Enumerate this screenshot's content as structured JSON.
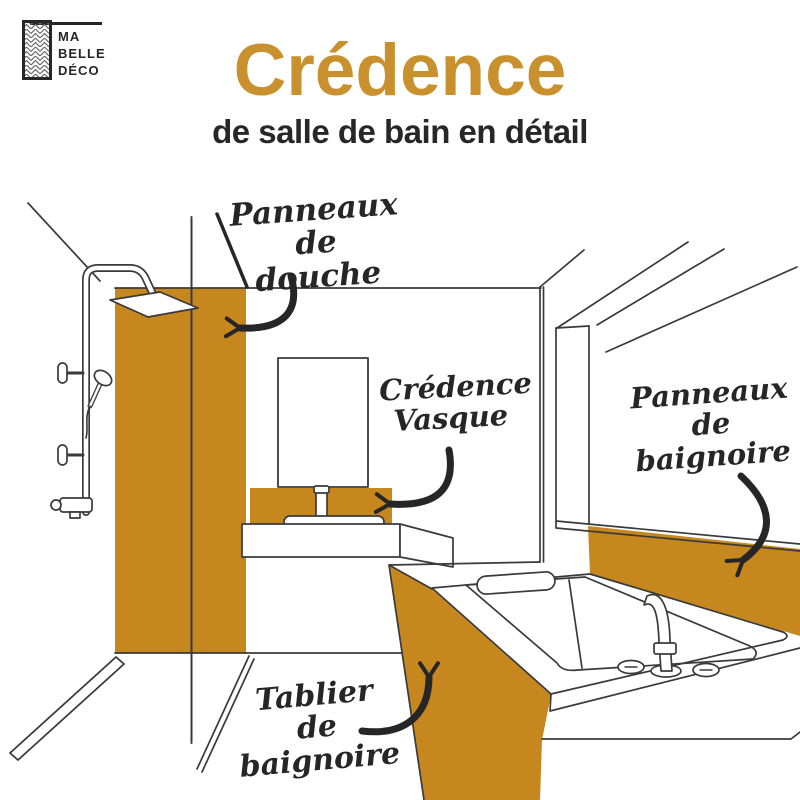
{
  "logo": {
    "line1": "MA",
    "line2": "BELLE",
    "line3": "DÉCO"
  },
  "header": {
    "title": "Crédence",
    "subtitle": "de salle de bain en détail"
  },
  "colors": {
    "accent": "#C6871F",
    "title-orange": "#C9912E",
    "ink": "#3A3A3A",
    "label-ink": "#262626"
  },
  "labels": {
    "douche": {
      "line1": "Panneaux",
      "line2": "de douche"
    },
    "vasque": {
      "line1": "Crédence",
      "line2": "Vasque"
    },
    "baignoire": {
      "line1": "Panneaux",
      "line2": "de baignoire"
    },
    "tablier": {
      "line1": "Tablier",
      "line2": "de baignoire"
    }
  }
}
